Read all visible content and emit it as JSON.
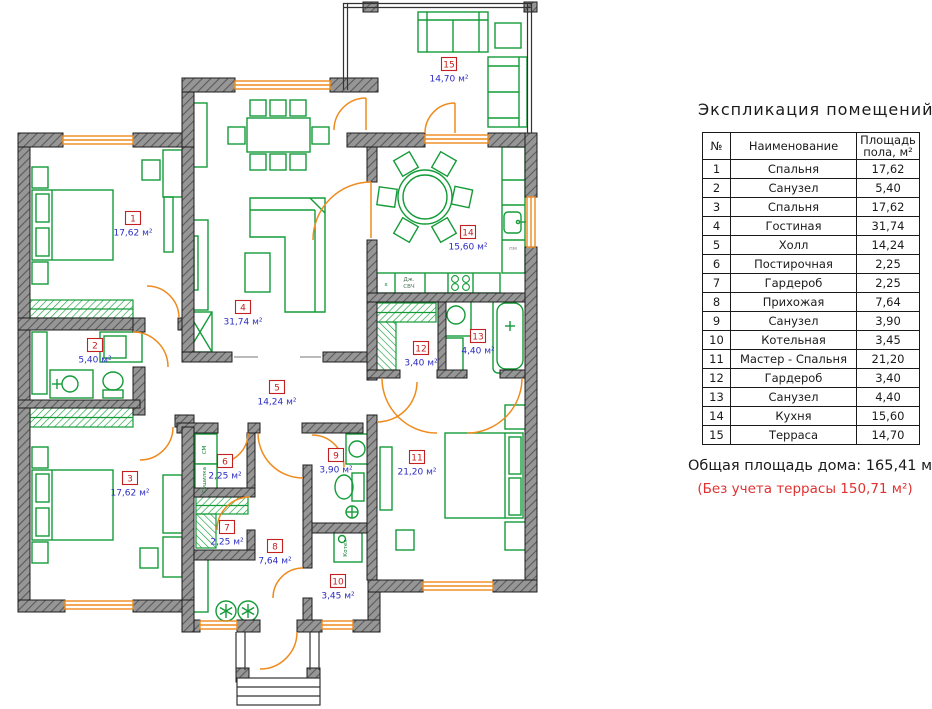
{
  "panel": {
    "title": "Экспликация помещений",
    "table": {
      "col_num": "№",
      "col_name": "Наименование",
      "col_area_l1": "Площадь",
      "col_area_l2": "пола, м²",
      "rows": [
        {
          "n": "1",
          "name": "Спальня",
          "area": "17,62"
        },
        {
          "n": "2",
          "name": "Санузел",
          "area": "5,40"
        },
        {
          "n": "3",
          "name": "Спальня",
          "area": "17,62"
        },
        {
          "n": "4",
          "name": "Гостиная",
          "area": "31,74"
        },
        {
          "n": "5",
          "name": "Холл",
          "area": "14,24"
        },
        {
          "n": "6",
          "name": "Постирочная",
          "area": "2,25"
        },
        {
          "n": "7",
          "name": "Гардероб",
          "area": "2,25"
        },
        {
          "n": "8",
          "name": "Прихожая",
          "area": "7,64"
        },
        {
          "n": "9",
          "name": "Санузел",
          "area": "3,90"
        },
        {
          "n": "10",
          "name": "Котельная",
          "area": "3,45"
        },
        {
          "n": "11",
          "name": "Мастер - Спальня",
          "area": "21,20"
        },
        {
          "n": "12",
          "name": "Гардероб",
          "area": "3,40"
        },
        {
          "n": "13",
          "name": "Санузел",
          "area": "4,40"
        },
        {
          "n": "14",
          "name": "Кухня",
          "area": "15,60"
        },
        {
          "n": "15",
          "name": "Терраса",
          "area": "14,70"
        }
      ]
    },
    "total_label": "Общая площадь дома:",
    "total_value": "165,41 м²",
    "note": "(Без учета террасы 150,71 м²)"
  },
  "floor_plan": {
    "rooms": [
      {
        "num": "1",
        "area": "17,62 м²",
        "x": 133,
        "y": 218
      },
      {
        "num": "2",
        "area": "5,40 м²",
        "x": 95,
        "y": 345
      },
      {
        "num": "3",
        "area": "17,62 м²",
        "x": 130,
        "y": 478
      },
      {
        "num": "4",
        "area": "31,74 м²",
        "x": 243,
        "y": 307
      },
      {
        "num": "5",
        "area": "14,24 м²",
        "x": 277,
        "y": 387
      },
      {
        "num": "6",
        "area": "2,25 м²",
        "x": 225,
        "y": 461
      },
      {
        "num": "7",
        "area": "2,25 м²",
        "x": 227,
        "y": 527
      },
      {
        "num": "8",
        "area": "7,64 м²",
        "x": 275,
        "y": 546
      },
      {
        "num": "9",
        "area": "3,90 м²",
        "x": 336,
        "y": 455
      },
      {
        "num": "10",
        "area": "3,45 м²",
        "x": 338,
        "y": 581
      },
      {
        "num": "11",
        "area": "21,20 м²",
        "x": 417,
        "y": 457
      },
      {
        "num": "12",
        "area": "3,40 м²",
        "x": 421,
        "y": 348
      },
      {
        "num": "13",
        "area": "4,40 м²",
        "x": 478,
        "y": 336
      },
      {
        "num": "14",
        "area": "15,60 м²",
        "x": 468,
        "y": 232
      },
      {
        "num": "15",
        "area": "14,70 м²",
        "x": 449,
        "y": 64
      }
    ],
    "annotations": [
      {
        "text": "СМ",
        "x": 206,
        "y": 450,
        "rot": -90,
        "c": "#0e7d31"
      },
      {
        "text": "Сушилка",
        "x": 206,
        "y": 480,
        "rot": -90,
        "c": "#0e7d31"
      },
      {
        "text": "Котел",
        "x": 347,
        "y": 548,
        "rot": -90,
        "c": "#0e7d31"
      },
      {
        "text": "Дж.",
        "x": 409,
        "y": 281,
        "rot": 0,
        "c": "#4a6e55"
      },
      {
        "text": "СВЧ",
        "x": 409,
        "y": 288,
        "rot": 0,
        "c": "#4a6e55"
      },
      {
        "text": "x",
        "x": 386,
        "y": 286,
        "rot": 0,
        "c": "#0e7d31"
      },
      {
        "text": "пм",
        "x": 513,
        "y": 250,
        "rot": 0,
        "c": "#8a8a8a"
      }
    ]
  },
  "colors": {
    "wall_fill": "#969696",
    "wall_hatch": "#5a5a5a",
    "furniture_green": "#149b38",
    "opening_orange": "#ef8a1d",
    "room_number_red": "#c42020",
    "room_area_blue": "#2b2bc4",
    "note_red": "#e03131"
  }
}
